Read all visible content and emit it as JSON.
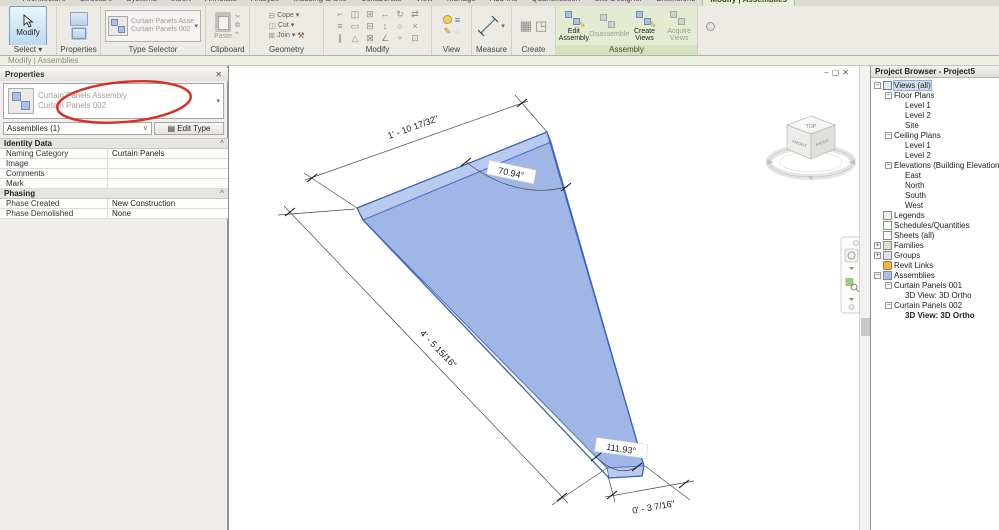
{
  "icons": {
    "minimize": "‒",
    "restore": "▢",
    "close": "✕",
    "caret": "^",
    "dropdown": "▾",
    "chevron": "∨",
    "pin": "^",
    "edit_type": "▤",
    "hammer": "⚒"
  },
  "ribbon": {
    "tabs": [
      "Architecture",
      "Structure",
      "Systems",
      "Insert",
      "Annotate",
      "Analyze",
      "Massing & Site",
      "Collaborate",
      "View",
      "Manage",
      "Add-Ins",
      "Quantification",
      "Site Designer",
      "Extensions"
    ],
    "active_tab": "Modify | Assemblies",
    "select_panel": {
      "button": "Modify",
      "label": "Select ▾"
    },
    "properties_panel": {
      "label": "Properties"
    },
    "type_selector": {
      "line1": "Curtain Panels Assembly",
      "line2": "Curtain Panels 002",
      "label": "Type Selector"
    },
    "clipboard": {
      "button": "Paste",
      "label": "Clipboard"
    },
    "geometry": {
      "items": [
        "Cope",
        "Cut",
        "Join"
      ],
      "row_icons": [
        "⊟",
        "◫",
        "⊠"
      ],
      "label": "Geometry"
    },
    "modify": {
      "label": "Modify",
      "glyphs": [
        {
          "name": "align-icon",
          "g": "⌐"
        },
        {
          "name": "mirror-icon",
          "g": "◫"
        },
        {
          "name": "array-icon",
          "g": "⊞"
        },
        {
          "name": "move-icon",
          "g": "↔"
        },
        {
          "name": "rotate-icon",
          "g": "↻"
        },
        {
          "name": "match-icon",
          "g": "⇄"
        },
        {
          "name": "offset-icon",
          "g": "≡"
        },
        {
          "name": "scale-icon",
          "g": "▭"
        },
        {
          "name": "group-icon",
          "g": "⊟"
        },
        {
          "name": "split-icon",
          "g": "↕"
        },
        {
          "name": "pin-icon",
          "g": "○"
        },
        {
          "name": "delete-icon",
          "g": "×"
        },
        {
          "name": "join-line-icon",
          "g": "∥"
        },
        {
          "name": "trim-icon",
          "g": "△"
        },
        {
          "name": "unjoin-icon",
          "g": "⊠"
        },
        {
          "name": "angle-icon",
          "g": "∠"
        },
        {
          "name": "divide-icon",
          "g": "÷"
        },
        {
          "name": "region-icon",
          "g": "⊡"
        }
      ]
    },
    "view": {
      "label": "View"
    },
    "measure": {
      "label": "Measure"
    },
    "create": {
      "label": "Create",
      "glyph1": "▦",
      "glyph2": "◳"
    },
    "assembly": {
      "label": "Assembly",
      "buttons": [
        {
          "label": "Edit Assembly",
          "enabled": true
        },
        {
          "label": "Disassemble",
          "enabled": false
        },
        {
          "label": "Create Views",
          "enabled": true
        },
        {
          "label": "Acquire Views",
          "enabled": false
        }
      ]
    }
  },
  "options_bar": {
    "text": "Modify | Assemblies"
  },
  "properties": {
    "title": "Properties",
    "type_line1": "Curtain Panels Assembly",
    "type_line2": "Curtain Panels 002",
    "filter": "Assemblies (1)",
    "edit_type": "Edit Type",
    "sections": [
      {
        "name": "Identity Data",
        "rows": [
          [
            "Naming Category",
            "Curtain Panels"
          ],
          [
            "Image",
            ""
          ],
          [
            "Comments",
            ""
          ],
          [
            "Mark",
            ""
          ]
        ]
      },
      {
        "name": "Phasing",
        "rows": [
          [
            "Phase Created",
            "New Construction"
          ],
          [
            "Phase Demolished",
            "None"
          ]
        ]
      }
    ]
  },
  "viewport": {
    "dims": {
      "top": "1' - 10 17/32\"",
      "left": "4' - 5 15/16\"",
      "bottom": "0' - 3 7/16\"",
      "angle_top": "70.94°",
      "angle_bottom": "111.93°"
    },
    "viewcube": {
      "top": "TOP",
      "front": "FRONT",
      "right": "RIGHT"
    },
    "panel_fill": "#9fb6e7",
    "panel_edge": "#3c63b8"
  },
  "project_browser": {
    "title": "Project Browser - Project5",
    "tree": [
      {
        "label": "Views (all)",
        "indent": 0,
        "exp": "minus",
        "icon": "views",
        "selected": true
      },
      {
        "label": "Floor Plans",
        "indent": 1,
        "exp": "minus",
        "icon": ""
      },
      {
        "label": "Level 1",
        "indent": 2,
        "exp": "",
        "icon": ""
      },
      {
        "label": "Level 2",
        "indent": 2,
        "exp": "",
        "icon": ""
      },
      {
        "label": "Site",
        "indent": 2,
        "exp": "",
        "icon": ""
      },
      {
        "label": "Ceiling Plans",
        "indent": 1,
        "exp": "minus",
        "icon": ""
      },
      {
        "label": "Level 1",
        "indent": 2,
        "exp": "",
        "icon": ""
      },
      {
        "label": "Level 2",
        "indent": 2,
        "exp": "",
        "icon": ""
      },
      {
        "label": "Elevations (Building Elevation)",
        "indent": 1,
        "exp": "minus",
        "icon": ""
      },
      {
        "label": "East",
        "indent": 2,
        "exp": "",
        "icon": ""
      },
      {
        "label": "North",
        "indent": 2,
        "exp": "",
        "icon": ""
      },
      {
        "label": "South",
        "indent": 2,
        "exp": "",
        "icon": ""
      },
      {
        "label": "West",
        "indent": 2,
        "exp": "",
        "icon": ""
      },
      {
        "label": "Legends",
        "indent": 0,
        "exp": "",
        "icon": "legend"
      },
      {
        "label": "Schedules/Quantities",
        "indent": 0,
        "exp": "",
        "icon": "schedule"
      },
      {
        "label": "Sheets (all)",
        "indent": 0,
        "exp": "",
        "icon": "sheet"
      },
      {
        "label": "Families",
        "indent": 0,
        "exp": "plus",
        "icon": "family"
      },
      {
        "label": "Groups",
        "indent": 0,
        "exp": "plus",
        "icon": "group"
      },
      {
        "label": "Revit Links",
        "indent": 0,
        "exp": "",
        "icon": "link"
      },
      {
        "label": "Assemblies",
        "indent": 0,
        "exp": "minus",
        "icon": "assembly"
      },
      {
        "label": "Curtain Panels 001",
        "indent": 1,
        "exp": "minus",
        "icon": ""
      },
      {
        "label": "3D View: 3D Ortho",
        "indent": 2,
        "exp": "",
        "icon": ""
      },
      {
        "label": "Curtain Panels 002",
        "indent": 1,
        "exp": "minus",
        "icon": ""
      },
      {
        "label": "3D View: 3D Ortho",
        "indent": 2,
        "exp": "",
        "icon": "",
        "bold": true
      }
    ]
  },
  "annotation": {
    "color": "#d93025"
  }
}
